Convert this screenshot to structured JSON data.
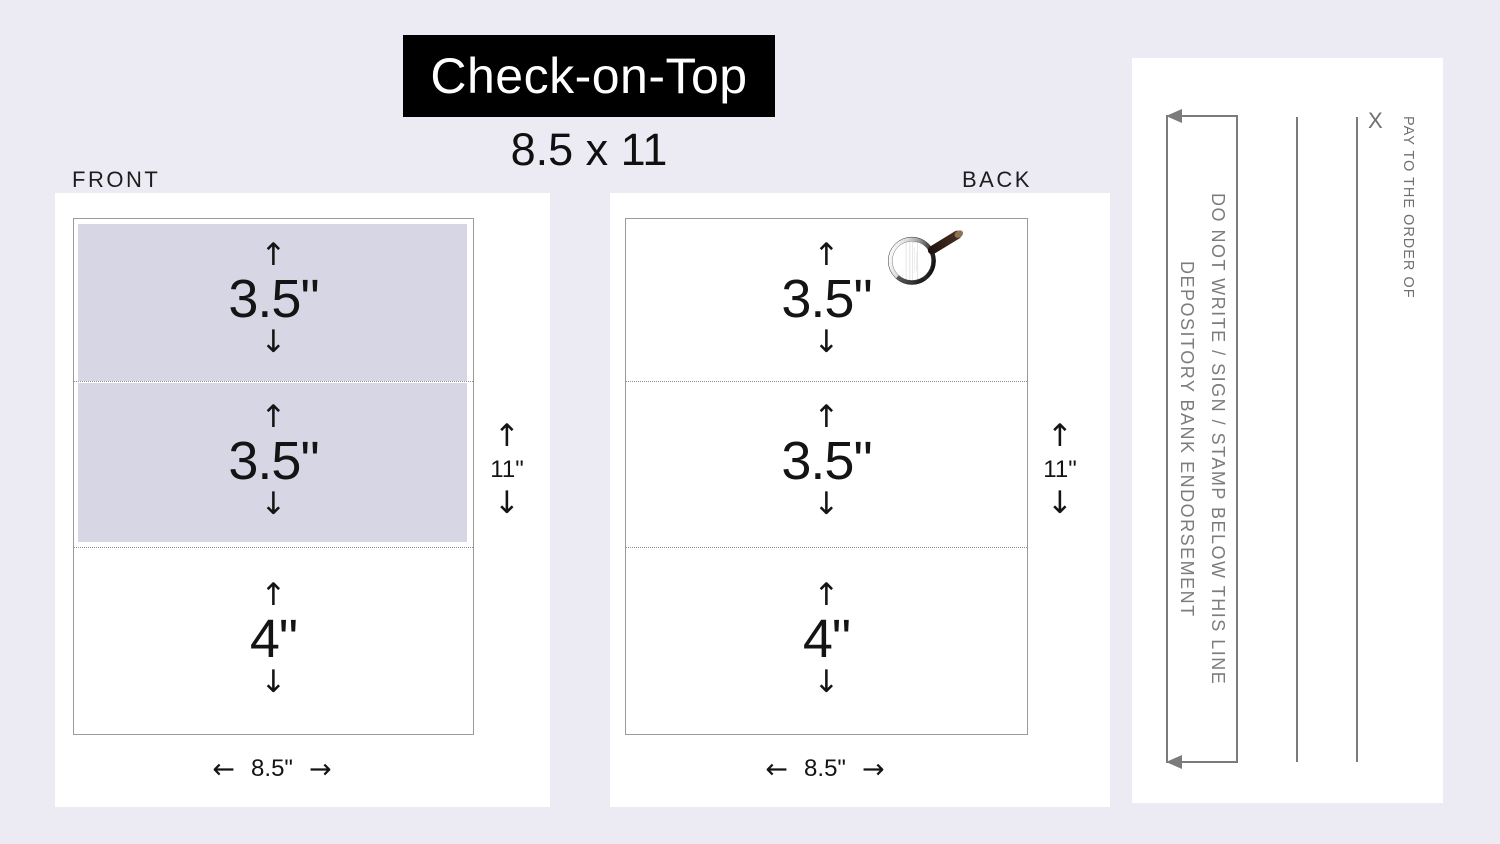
{
  "header": {
    "product_name": "Check-on-Top",
    "sheet_size": "8.5 x 11"
  },
  "icons": {
    "up_arrow": "↑",
    "down_arrow": "↓",
    "left_arrow": "←",
    "right_arrow": "→"
  },
  "front_panel": {
    "label": "FRONT",
    "sections": [
      {
        "size": "3.5\"",
        "shaded": true
      },
      {
        "size": "3.5\"",
        "shaded": true
      },
      {
        "size": "4\"",
        "shaded": false
      }
    ],
    "page_height": "11\"",
    "page_width": "8.5\""
  },
  "back_panel": {
    "label": "BACK",
    "sections": [
      {
        "size": "3.5\"",
        "shaded": false
      },
      {
        "size": "3.5\"",
        "shaded": false
      },
      {
        "size": "4\"",
        "shaded": false
      }
    ],
    "page_height": "11\"",
    "page_width": "8.5\""
  },
  "endorsement_detail": {
    "do_not_write_line": "DO NOT WRITE / SIGN / STAMP BELOW THIS LINE",
    "depository_line": "DEPOSITORY BANK ENDORSEMENT",
    "x_mark": "X",
    "pay_to_order": "PAY TO THE ORDER OF"
  },
  "colors": {
    "background": "#ecebf3",
    "panel": "#ffffff",
    "check_shade": "#d7d6e4",
    "banner_bg": "#000000",
    "banner_text": "#ffffff",
    "dimension_text": "#141414",
    "detail_gray": "#7b7b7b",
    "handle_brown": "#35211a",
    "handle_tip": "#8d7354"
  }
}
